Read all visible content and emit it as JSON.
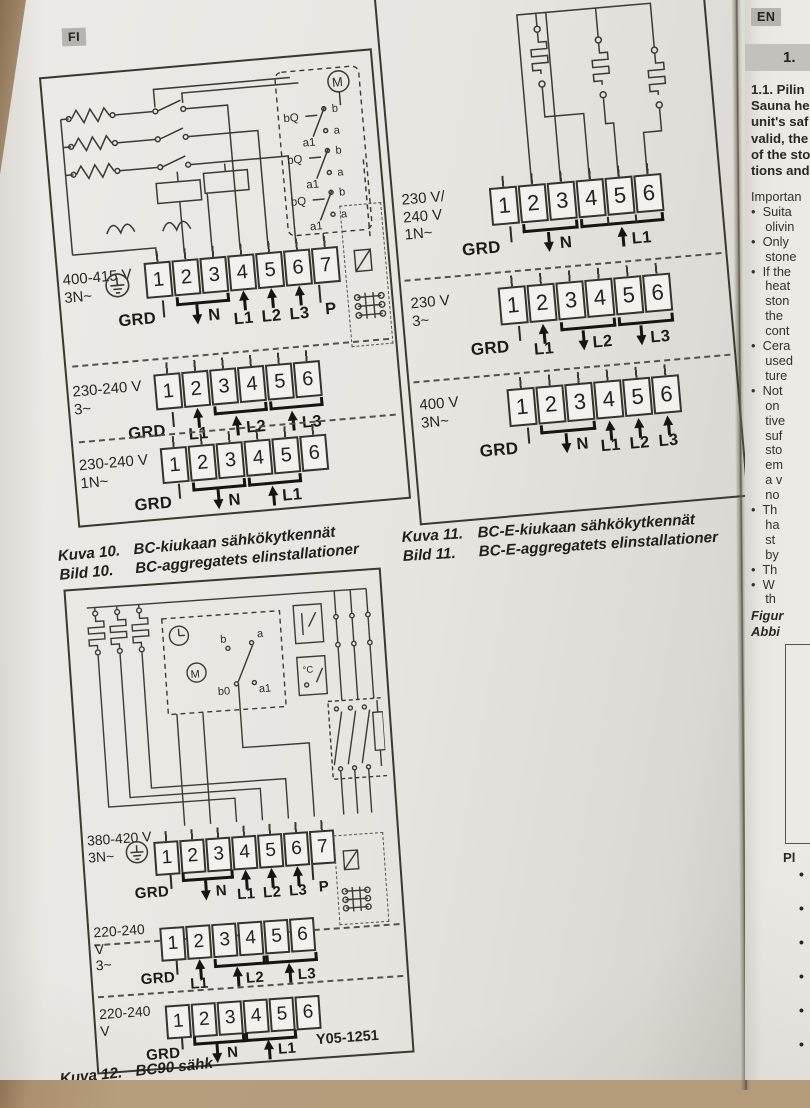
{
  "colors": {
    "desk": "#b29a7b",
    "page": "#e7e5e0",
    "ink": "#2c2a23",
    "badge_bg": "#b6b4af",
    "header_bar": "#c3c1bb"
  },
  "fi_page": {
    "lang_badge": "FI",
    "fig10": {
      "motor_label": "M",
      "relay_coil_label": "bQ",
      "relay_term_label": "a1",
      "contact_b": "b",
      "contact_a": "a",
      "blocks": {
        "b1": {
          "volt": "400-415 V",
          "phase": "3N~",
          "terminals": [
            "1",
            "2",
            "3",
            "4",
            "5",
            "6",
            "7"
          ],
          "grd": "GRD",
          "n": "N",
          "l1": "L1",
          "l2": "L2",
          "l3": "L3",
          "p": "P"
        },
        "b2": {
          "volt": "230-240 V",
          "phase": "3~",
          "terminals": [
            "1",
            "2",
            "3",
            "4",
            "5",
            "6"
          ],
          "grd": "GRD",
          "l1": "L1",
          "l2": "L2",
          "l3": "L3"
        },
        "b3": {
          "volt": "230-240 V",
          "phase": "1N~",
          "terminals": [
            "1",
            "2",
            "3",
            "4",
            "5",
            "6"
          ],
          "grd": "GRD",
          "n": "N",
          "l1": "L1"
        }
      },
      "caption": {
        "fi_label": "Kuva 10.",
        "fi_text": "BC-kiukaan sähkökytkennät",
        "sv_label": "Bild 10.",
        "sv_text": "BC-aggregatets elinstallationer"
      }
    },
    "fig11": {
      "blocks": {
        "b1": {
          "volt1": "230 V/",
          "volt2": "240 V",
          "phase": "1N~",
          "terminals": [
            "1",
            "2",
            "3",
            "4",
            "5",
            "6"
          ],
          "grd": "GRD",
          "n": "N",
          "l1": "L1"
        },
        "b2": {
          "volt": "230 V",
          "phase": "3~",
          "terminals": [
            "1",
            "2",
            "3",
            "4",
            "5",
            "6"
          ],
          "grd": "GRD",
          "l1": "L1",
          "l2": "L2",
          "l3": "L3"
        },
        "b3": {
          "volt": "400 V",
          "phase": "3N~",
          "terminals": [
            "1",
            "2",
            "3",
            "4",
            "5",
            "6"
          ],
          "grd": "GRD",
          "n": "N",
          "l1": "L1",
          "l2": "L2",
          "l3": "L3"
        }
      },
      "caption": {
        "fi_label": "Kuva 11.",
        "fi_text": "BC-E-kiukaan sähkökytkennät",
        "sv_label": "Bild 11.",
        "sv_text": "BC-E-aggregatets elinstallationer"
      }
    },
    "fig12": {
      "motor_label": "M",
      "sw_b": "b",
      "sw_a": "a",
      "sw_b0": "b0",
      "sw_a1": "a1",
      "thermo": "°C",
      "blocks": {
        "b1": {
          "volt": "380-420 V",
          "phase": "3N~",
          "terminals": [
            "1",
            "2",
            "3",
            "4",
            "5",
            "6",
            "7"
          ],
          "grd": "GRD",
          "n": "N",
          "l1": "L1",
          "l2": "L2",
          "l3": "L3",
          "p": "P"
        },
        "b2": {
          "volt": "220-240 V",
          "phase": "3~",
          "terminals": [
            "1",
            "2",
            "3",
            "4",
            "5",
            "6"
          ],
          "grd": "GRD",
          "l1": "L1",
          "l2": "L2",
          "l3": "L3"
        },
        "b3": {
          "volt": "220-240 V",
          "terminals": [
            "1",
            "2",
            "3",
            "4",
            "5",
            "6"
          ],
          "grd": "GRD",
          "n": "N",
          "l1": "L1"
        }
      },
      "caption": {
        "fi_label": "Kuva 12.",
        "fi_text": "BC90 sähk",
        "sv_label": "Bild 12.",
        "sv_text": ""
      },
      "doc_number": "Y05-1251"
    }
  },
  "en_page": {
    "lang_badge": "EN",
    "section_header": "1.",
    "intro_lines": [
      "1.1. Pilin",
      "Sauna he",
      "unit's saf",
      "valid, the",
      "of the sto",
      "tions and"
    ],
    "body_lines": [
      "Importan",
      "•  Suita",
      "    olivin",
      "•  Only",
      "    stone",
      "•  If the",
      "    heat",
      "    ston",
      "    the",
      "    cont",
      "•  Cera",
      "    used",
      "    ture",
      "•  Not",
      "    on",
      "    tive",
      "    suf",
      "    sto",
      "    em",
      "    a v",
      "    no",
      "•  Th",
      "    ha",
      "    st",
      "    by",
      "•  Th",
      "•  W",
      "    th"
    ],
    "figure_caption_lines": [
      "Figur",
      "Abbi"
    ],
    "list_heading": "Pl",
    "list_bullets": [
      "•",
      "•",
      "•",
      "•",
      "•",
      "•"
    ]
  }
}
